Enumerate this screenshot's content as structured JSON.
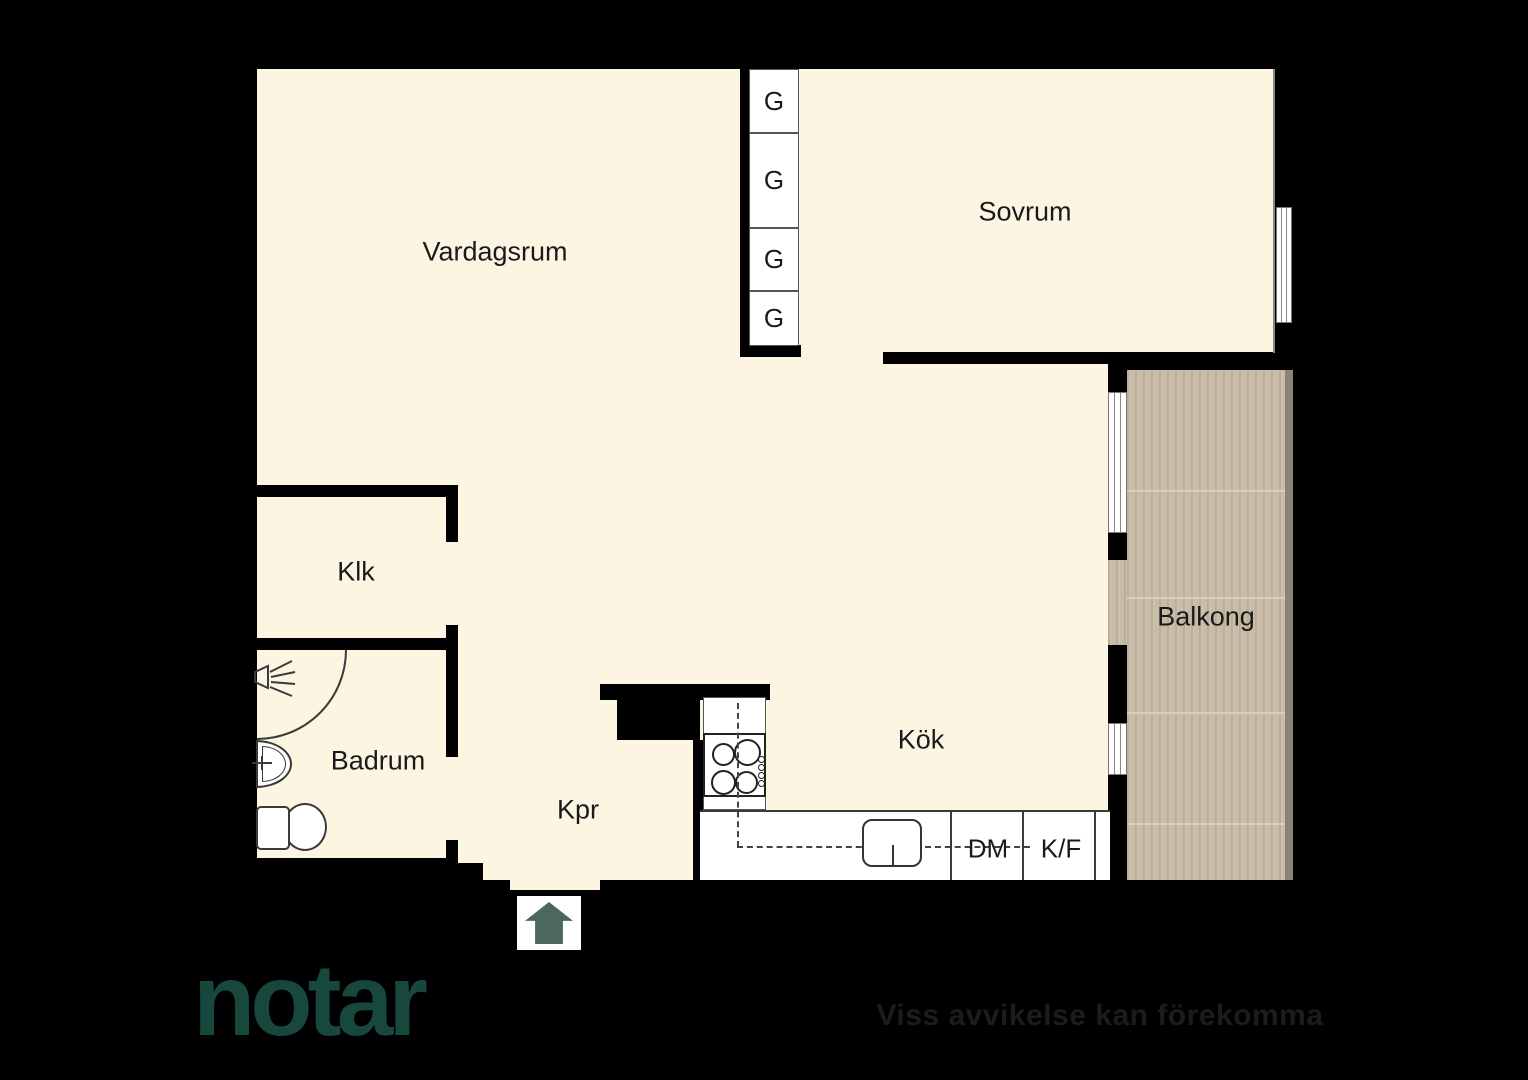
{
  "plan": {
    "rooms": [
      {
        "id": "vardagsrum",
        "label": "Vardagsrum"
      },
      {
        "id": "sovrum",
        "label": "Sovrum"
      },
      {
        "id": "klk",
        "label": "Klk"
      },
      {
        "id": "badrum",
        "label": "Badrum"
      },
      {
        "id": "kpr",
        "label": "Kpr"
      },
      {
        "id": "kok",
        "label": "Kök"
      },
      {
        "id": "balkong",
        "label": "Balkong"
      }
    ],
    "wardrobes": [
      {
        "label": "G"
      },
      {
        "label": "G"
      },
      {
        "label": "G"
      },
      {
        "label": "G"
      }
    ],
    "appliances": {
      "dishwasher": "DM",
      "fridge_freezer": "K/F"
    }
  },
  "branding": {
    "logo_text": "notar",
    "disclaimer": "Viss avvikelse kan förekomma"
  },
  "colors": {
    "background": "#000000",
    "floor": "#FCF5E2",
    "wall": "#000000",
    "balcony_deck": "#C9BCA7",
    "balcony_rail": "#8C8378",
    "entrance_arrow": "#4B675F",
    "fixture_line": "#3a3a3a",
    "label_text": "#1a1a1a",
    "logo_color": "#17473D",
    "disclaimer_color": "#1c1c1c"
  }
}
